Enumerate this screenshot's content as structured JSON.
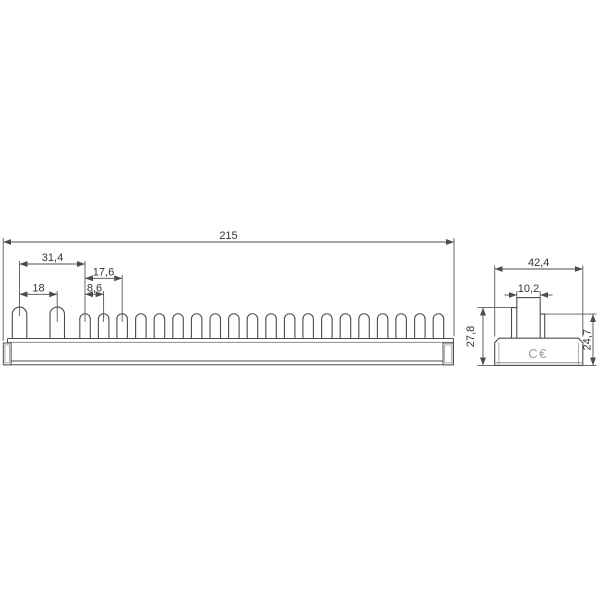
{
  "front_view": {
    "dims": {
      "total_length": "215",
      "pin1_to_pin3": "31,4",
      "pin3_to_pin5": "17,6",
      "pin1_to_pin2": "18",
      "pin3_to_pin4": "8,6"
    },
    "teeth": {
      "large_pins": 2,
      "small_pins": 20
    }
  },
  "side_view": {
    "dims": {
      "overall_width": "42,4",
      "pin_width": "10,2",
      "overall_height": "27,8",
      "body_height": "24,7"
    },
    "marking": "C€"
  }
}
